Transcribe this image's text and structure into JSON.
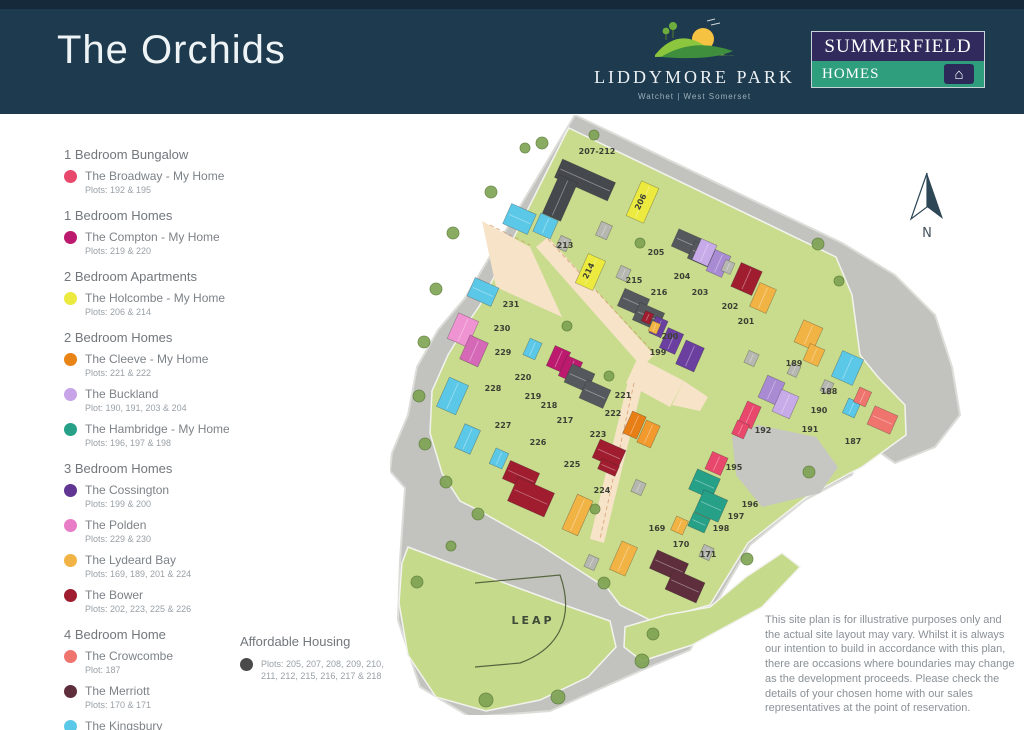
{
  "header": {
    "title": "The Orchids",
    "development": {
      "name": "LIDDYMORE PARK",
      "location": "Watchet | West Somerset"
    },
    "builder": {
      "line1": "SUMMERFIELD",
      "line2": "HOMES"
    }
  },
  "legend": {
    "categories": [
      {
        "label": "1 Bedroom Bungalow",
        "items": [
          {
            "name": "The Broadway - My Home",
            "plots": "Plots: 192 & 195",
            "color": "#e8486c"
          }
        ]
      },
      {
        "label": "1 Bedroom Homes",
        "items": [
          {
            "name": "The Compton - My Home",
            "plots": "Plots: 219 & 220",
            "color": "#bc1a6e"
          }
        ]
      },
      {
        "label": "2 Bedroom Apartments",
        "items": [
          {
            "name": "The Holcombe - My Home",
            "plots": "Plots: 206 & 214",
            "color": "#ece93f"
          }
        ]
      },
      {
        "label": "2 Bedroom Homes",
        "items": [
          {
            "name": "The Cleeve - My Home",
            "plots": "Plots: 221 & 222",
            "color": "#e88316"
          },
          {
            "name": "The Buckland",
            "plots": "Plot: 190, 191, 203 & 204",
            "color": "#c7a3e8"
          },
          {
            "name": "The Hambridge - My Home",
            "plots": "Plots: 196, 197 & 198",
            "color": "#27a088"
          }
        ]
      },
      {
        "label": "3 Bedroom Homes",
        "items": [
          {
            "name": "The Cossington",
            "plots": "Plots: 199 & 200",
            "color": "#613592"
          },
          {
            "name": "The Polden",
            "plots": "Plots: 229 & 230",
            "color": "#e87cc6"
          },
          {
            "name": "The Lydeard Bay",
            "plots": "Plots: 169, 189, 201 & 224",
            "color": "#f2b345"
          },
          {
            "name": "The Bower",
            "plots": "Plots: 202, 223, 225 & 226",
            "color": "#a01d30"
          }
        ]
      },
      {
        "label": "4 Bedroom Home",
        "items": [
          {
            "name": "The Crowcombe",
            "plots": "Plot: 187",
            "color": "#ef746e"
          },
          {
            "name": "The Merriott",
            "plots": "Plots: 170 & 171",
            "color": "#5f2e3d"
          },
          {
            "name": "The Kingsbury",
            "plots": "Plots: 188, 213, 227, 228 & 231",
            "color": "#5cc8e8"
          }
        ]
      }
    ]
  },
  "affordable": {
    "label": "Affordable Housing",
    "plots": "Plots: 205, 207, 208, 209, 210, 211, 212, 215, 216, 217 & 218",
    "color": "#4a4a4a"
  },
  "disclaimer": "This site plan is for illustrative purposes only and the actual site layout may vary. Whilst it is always our intention to build in accordance with this plan, there are occasions where boundaries may change as the development proceeds. Please check the details of your chosen home with our sales representatives at the point of reservation.",
  "map": {
    "labels": {
      "leap": "LEAP",
      "north": "N"
    },
    "colors": {
      "broadway": "#e8486c",
      "compton": "#bc1a6e",
      "holcombe": "#ece93f",
      "cleeve": "#e87f16",
      "cleeve2": "#f29a2e",
      "buckland": "#a98bd4",
      "buckland2": "#c7aae8",
      "hambridge": "#27a088",
      "cossington": "#6b3fa0",
      "polden": "#d668b8",
      "polden2": "#ef93d2",
      "lydeard": "#f2b345",
      "bower": "#a01d30",
      "crowcombe": "#ef746e",
      "merriott": "#5f2e3d",
      "kingsbury": "#5cc8e8",
      "afford": "#55595e",
      "apt": "#45484d",
      "garage": "#b7b7b2"
    },
    "buildings": [
      [
        166,
        55,
        58,
        20,
        24,
        "apt"
      ],
      [
        160,
        62,
        20,
        42,
        24,
        "apt"
      ],
      [
        243,
        68,
        19,
        38,
        24,
        "holcombe"
      ],
      [
        116,
        93,
        27,
        22,
        24,
        "kingsbury"
      ],
      [
        146,
        101,
        19,
        20,
        24,
        "kingsbury"
      ],
      [
        191,
        141,
        19,
        32,
        24,
        "holcombe"
      ],
      [
        230,
        178,
        27,
        19,
        24,
        "afford"
      ],
      [
        245,
        192,
        27,
        19,
        24,
        "afford"
      ],
      [
        284,
        118,
        25,
        19,
        24,
        "afford"
      ],
      [
        300,
        130,
        25,
        19,
        24,
        "afford"
      ],
      [
        306,
        126,
        17,
        23,
        24,
        "buckland2"
      ],
      [
        320,
        137,
        17,
        23,
        24,
        "buckland"
      ],
      [
        345,
        151,
        23,
        26,
        24,
        "bower"
      ],
      [
        364,
        170,
        18,
        26,
        24,
        "lydeard"
      ],
      [
        262,
        203,
        13,
        18,
        24,
        "cossington"
      ],
      [
        273,
        215,
        17,
        22,
        24,
        "cossington"
      ],
      [
        290,
        228,
        20,
        26,
        24,
        "cossington"
      ],
      [
        253,
        197,
        9,
        11,
        24,
        "bower"
      ],
      [
        260,
        207,
        9,
        11,
        24,
        "lydeard"
      ],
      [
        408,
        208,
        21,
        24,
        24,
        "lydeard"
      ],
      [
        416,
        231,
        16,
        18,
        24,
        "lydeard"
      ],
      [
        446,
        239,
        23,
        28,
        24,
        "kingsbury"
      ],
      [
        455,
        285,
        13,
        16,
        24,
        "kingsbury"
      ],
      [
        372,
        263,
        19,
        24,
        24,
        "buckland"
      ],
      [
        386,
        277,
        19,
        24,
        24,
        "buckland2"
      ],
      [
        352,
        288,
        15,
        24,
        24,
        "broadway"
      ],
      [
        480,
        295,
        25,
        20,
        24,
        "crowcombe"
      ],
      [
        466,
        274,
        13,
        16,
        24,
        "crowcombe"
      ],
      [
        318,
        339,
        17,
        19,
        24,
        "broadway"
      ],
      [
        344,
        307,
        13,
        15,
        24,
        "broadway"
      ],
      [
        302,
        358,
        25,
        22,
        24,
        "hambridge"
      ],
      [
        308,
        379,
        26,
        24,
        24,
        "hambridge"
      ],
      [
        300,
        400,
        18,
        15,
        24,
        "hambridge"
      ],
      [
        283,
        403,
        13,
        15,
        24,
        "lydeard"
      ],
      [
        262,
        441,
        34,
        20,
        24,
        "merriott"
      ],
      [
        278,
        460,
        34,
        22,
        24,
        "merriott"
      ],
      [
        225,
        428,
        17,
        31,
        24,
        "lydeard"
      ],
      [
        115,
        351,
        32,
        20,
        24,
        "bower"
      ],
      [
        121,
        369,
        40,
        26,
        24,
        "bower"
      ],
      [
        205,
        329,
        28,
        20,
        24,
        "bower"
      ],
      [
        209,
        347,
        19,
        11,
        24,
        "bower"
      ],
      [
        179,
        381,
        17,
        38,
        24,
        "lydeard"
      ],
      [
        237,
        298,
        15,
        24,
        24,
        "cleeve"
      ],
      [
        251,
        307,
        15,
        24,
        24,
        "cleeve2"
      ],
      [
        160,
        233,
        17,
        22,
        24,
        "compton"
      ],
      [
        172,
        243,
        17,
        22,
        24,
        "compton"
      ],
      [
        136,
        225,
        13,
        18,
        24,
        "kingsbury"
      ],
      [
        62,
        201,
        22,
        28,
        24,
        "polden2"
      ],
      [
        74,
        223,
        20,
        26,
        24,
        "polden"
      ],
      [
        52,
        265,
        21,
        32,
        24,
        "kingsbury"
      ],
      [
        69,
        311,
        17,
        26,
        24,
        "kingsbury"
      ],
      [
        102,
        335,
        14,
        17,
        24,
        "kingsbury"
      ],
      [
        80,
        167,
        26,
        20,
        24,
        "kingsbury"
      ],
      [
        177,
        253,
        25,
        20,
        24,
        "afford"
      ],
      [
        192,
        269,
        26,
        20,
        24,
        "afford"
      ],
      [
        208,
        108,
        12,
        15,
        24,
        "garage"
      ],
      [
        168,
        122,
        11,
        13,
        24,
        "garage"
      ],
      [
        228,
        152,
        11,
        13,
        24,
        "garage"
      ],
      [
        333,
        146,
        10,
        12,
        24,
        "garage"
      ],
      [
        356,
        237,
        11,
        13,
        24,
        "garage"
      ],
      [
        243,
        366,
        11,
        13,
        24,
        "garage"
      ],
      [
        196,
        441,
        11,
        13,
        24,
        "garage"
      ],
      [
        311,
        431,
        11,
        13,
        24,
        "garage"
      ],
      [
        399,
        249,
        10,
        12,
        24,
        "garage"
      ],
      [
        432,
        266,
        10,
        12,
        24,
        "garage"
      ]
    ],
    "plots": [
      [
        "207-212",
        207,
        39,
        0
      ],
      [
        "206",
        253,
        88,
        -64
      ],
      [
        "213",
        175,
        133,
        0
      ],
      [
        "214",
        201,
        157,
        -64
      ],
      [
        "205",
        266,
        140,
        0
      ],
      [
        "215",
        244,
        168,
        0
      ],
      [
        "216",
        269,
        180,
        0
      ],
      [
        "204",
        292,
        164,
        0
      ],
      [
        "203",
        310,
        180,
        0
      ],
      [
        "202",
        340,
        194,
        0
      ],
      [
        "201",
        356,
        209,
        0
      ],
      [
        "200",
        280,
        224,
        0
      ],
      [
        "199",
        268,
        240,
        0
      ],
      [
        "189",
        404,
        251,
        0
      ],
      [
        "188",
        439,
        279,
        0
      ],
      [
        "190",
        429,
        298,
        0
      ],
      [
        "191",
        420,
        317,
        0
      ],
      [
        "192",
        373,
        318,
        0
      ],
      [
        "187",
        463,
        329,
        0
      ],
      [
        "195",
        344,
        355,
        0
      ],
      [
        "196",
        360,
        392,
        0
      ],
      [
        "197",
        346,
        404,
        0
      ],
      [
        "198",
        331,
        416,
        0
      ],
      [
        "169",
        267,
        416,
        0
      ],
      [
        "170",
        291,
        432,
        0
      ],
      [
        "171",
        318,
        442,
        0
      ],
      [
        "220",
        133,
        265,
        0
      ],
      [
        "219",
        143,
        284,
        0
      ],
      [
        "218",
        159,
        293,
        0
      ],
      [
        "217",
        175,
        308,
        0
      ],
      [
        "221",
        233,
        283,
        0
      ],
      [
        "222",
        223,
        301,
        0
      ],
      [
        "223",
        208,
        322,
        0
      ],
      [
        "224",
        212,
        378,
        0
      ],
      [
        "225",
        182,
        352,
        0
      ],
      [
        "226",
        148,
        330,
        0
      ],
      [
        "227",
        113,
        313,
        0
      ],
      [
        "228",
        103,
        276,
        0
      ],
      [
        "229",
        113,
        240,
        0
      ],
      [
        "230",
        112,
        216,
        0
      ],
      [
        "231",
        121,
        192,
        0
      ]
    ],
    "trees": [
      [
        152,
        28,
        6
      ],
      [
        204,
        20,
        5
      ],
      [
        101,
        77,
        6
      ],
      [
        63,
        118,
        6
      ],
      [
        46,
        174,
        6
      ],
      [
        34,
        227,
        6
      ],
      [
        29,
        281,
        6
      ],
      [
        35,
        329,
        6
      ],
      [
        56,
        367,
        6
      ],
      [
        88,
        399,
        6
      ],
      [
        61,
        431,
        5
      ],
      [
        27,
        467,
        6
      ],
      [
        96,
        585,
        7
      ],
      [
        168,
        582,
        7
      ],
      [
        252,
        546,
        7
      ],
      [
        214,
        468,
        6
      ],
      [
        300,
        473,
        6
      ],
      [
        357,
        444,
        6
      ],
      [
        419,
        357,
        6
      ],
      [
        428,
        129,
        6
      ],
      [
        449,
        166,
        5
      ],
      [
        250,
        128,
        5
      ],
      [
        177,
        211,
        5
      ],
      [
        219,
        261,
        5
      ],
      [
        205,
        394,
        5
      ],
      [
        263,
        519,
        6
      ],
      [
        135,
        33,
        5
      ]
    ]
  }
}
